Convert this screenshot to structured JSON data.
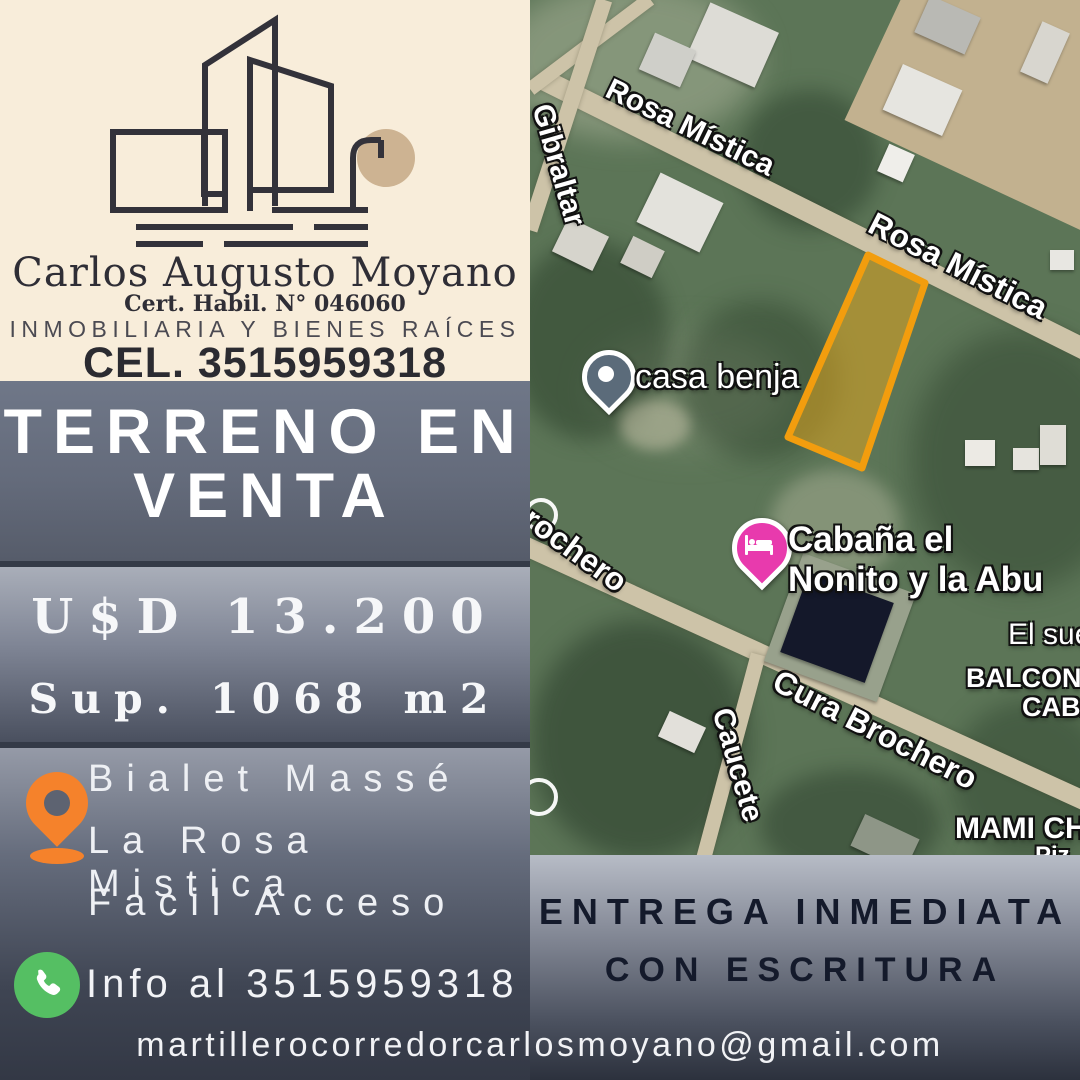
{
  "agency": {
    "logo": {
      "kind": "line-art-buildings-with-lamp",
      "line_color": "#33323a",
      "accent_circle_color": "#cdb392"
    },
    "name": "Carlos Augusto Moyano",
    "certification": "Cert. Habil. N° 046060",
    "tagline": "INMOBILIARIA Y BIENES RAÍCES",
    "phone_header": "CEL. 3515959318"
  },
  "listing": {
    "title_lines": [
      "TERRENO EN",
      "VENTA"
    ],
    "price": "U$D 13.200",
    "surface": "Sup. 1068 m2",
    "location_lines": [
      "Bialet Massé",
      "La Rosa Mistica",
      "Facil Acceso"
    ]
  },
  "contact": {
    "info_line": "Info al 3515959318",
    "email": "martillerocorredorcarlosmoyano@gmail.com"
  },
  "highlight": {
    "lines": [
      "ENTREGA INMEDIATA",
      "CON ESCRITURA"
    ]
  },
  "map": {
    "type": "satellite",
    "street_labels": [
      {
        "text": "Gibraltar"
      },
      {
        "text": "Rosa Mística"
      },
      {
        "text": "Rosa Mística"
      },
      {
        "text": "rochero"
      },
      {
        "text": "Caucete"
      },
      {
        "text": "Cura Brochero"
      }
    ],
    "place_labels": [
      {
        "text": "El sue"
      },
      {
        "text": "BALCON MISTICO"
      },
      {
        "text": "CABAÑA"
      },
      {
        "text": "MAMI CHE"
      },
      {
        "text": "Piz"
      }
    ],
    "markers": [
      {
        "label": "casa benja",
        "color": "#5b6b7a"
      },
      {
        "label_line1": "Cabaña el",
        "label_line2": "Nonito y la Abu",
        "color": "#e83aad"
      }
    ],
    "parcel_highlight": {
      "stroke": "#f29d0e",
      "fill": "rgba(235,170,25,0.5)"
    }
  },
  "colors": {
    "header_bg": "#f8edda",
    "pin_orange": "#f5822b",
    "phone_green": "#55bf63",
    "highlight_text": "#141a2b",
    "light_text": "#f1f2f5"
  }
}
